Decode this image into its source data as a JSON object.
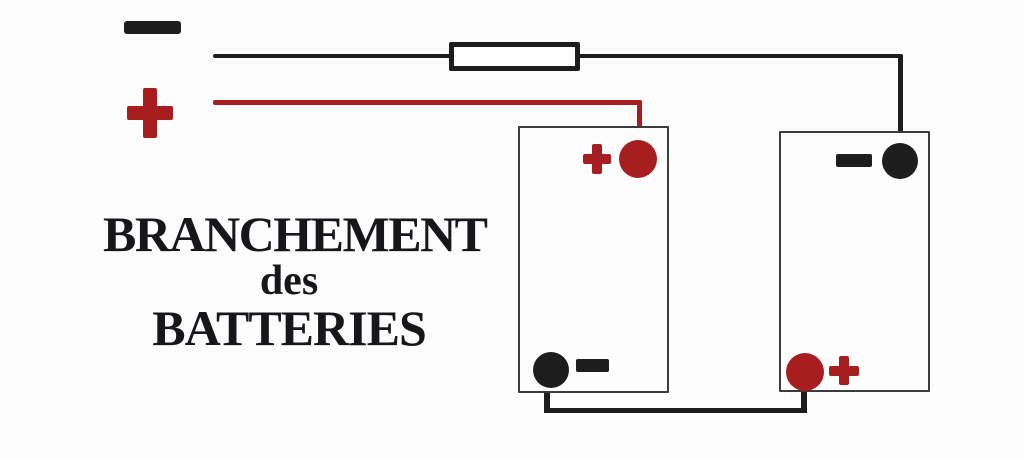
{
  "colors": {
    "red": "#a81d20",
    "black": "#1d1d1d",
    "ink": "#17171b",
    "border": "#3c3c3c",
    "bg": "#fcfcfc"
  },
  "title": {
    "line1": "BRANCHEMENT",
    "line2": "des",
    "line3": "BATTERIES"
  },
  "legend": {
    "negative_symbol": "−",
    "positive_symbol": "+"
  },
  "diagram": {
    "type": "series-battery-wiring-schematic",
    "batteries": [
      {
        "id": "battery-1",
        "top_terminal": "+",
        "bottom_terminal": "−"
      },
      {
        "id": "battery-2",
        "top_terminal": "−",
        "bottom_terminal": "+"
      }
    ],
    "wires": [
      {
        "id": "negative-wire",
        "color": "black",
        "path": "negative lead through fuse to battery-2 top (−) terminal"
      },
      {
        "id": "positive-wire",
        "color": "red",
        "path": "positive lead to battery-1 top (+) terminal"
      },
      {
        "id": "series-link-wire",
        "color": "black",
        "path": "battery-1 bottom (−) terminal to battery-2 bottom (+) terminal"
      }
    ],
    "fuse_present": true
  }
}
